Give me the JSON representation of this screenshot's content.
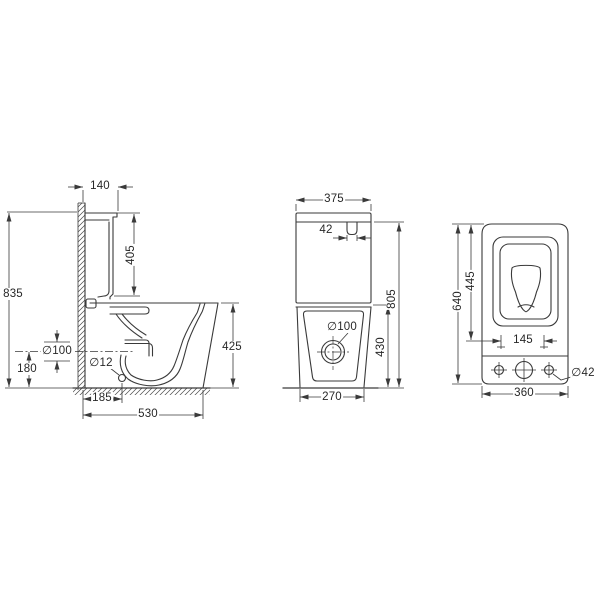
{
  "side_view": {
    "dims": {
      "tank_depth": "140",
      "tank_height": "405",
      "overall_height": "835",
      "seat_height": "425",
      "outlet_diameter": "∅100",
      "outlet_height": "180",
      "fixing_hole_diameter": "∅12",
      "outlet_offset": "185",
      "overall_depth": "530"
    }
  },
  "front_view": {
    "dims": {
      "tank_width": "375",
      "button_width": "42",
      "outlet_diameter": "∅100",
      "bowl_height": "430",
      "overall_height": "805",
      "base_width": "270"
    }
  },
  "top_view": {
    "dims": {
      "overall_depth": "640",
      "seat_length": "445",
      "fixing_hole_spacing": "145",
      "fixing_hole_diameter": "∅42",
      "overall_width": "360"
    }
  },
  "colors": {
    "line": "#3a3a3a",
    "background": "#ffffff"
  }
}
